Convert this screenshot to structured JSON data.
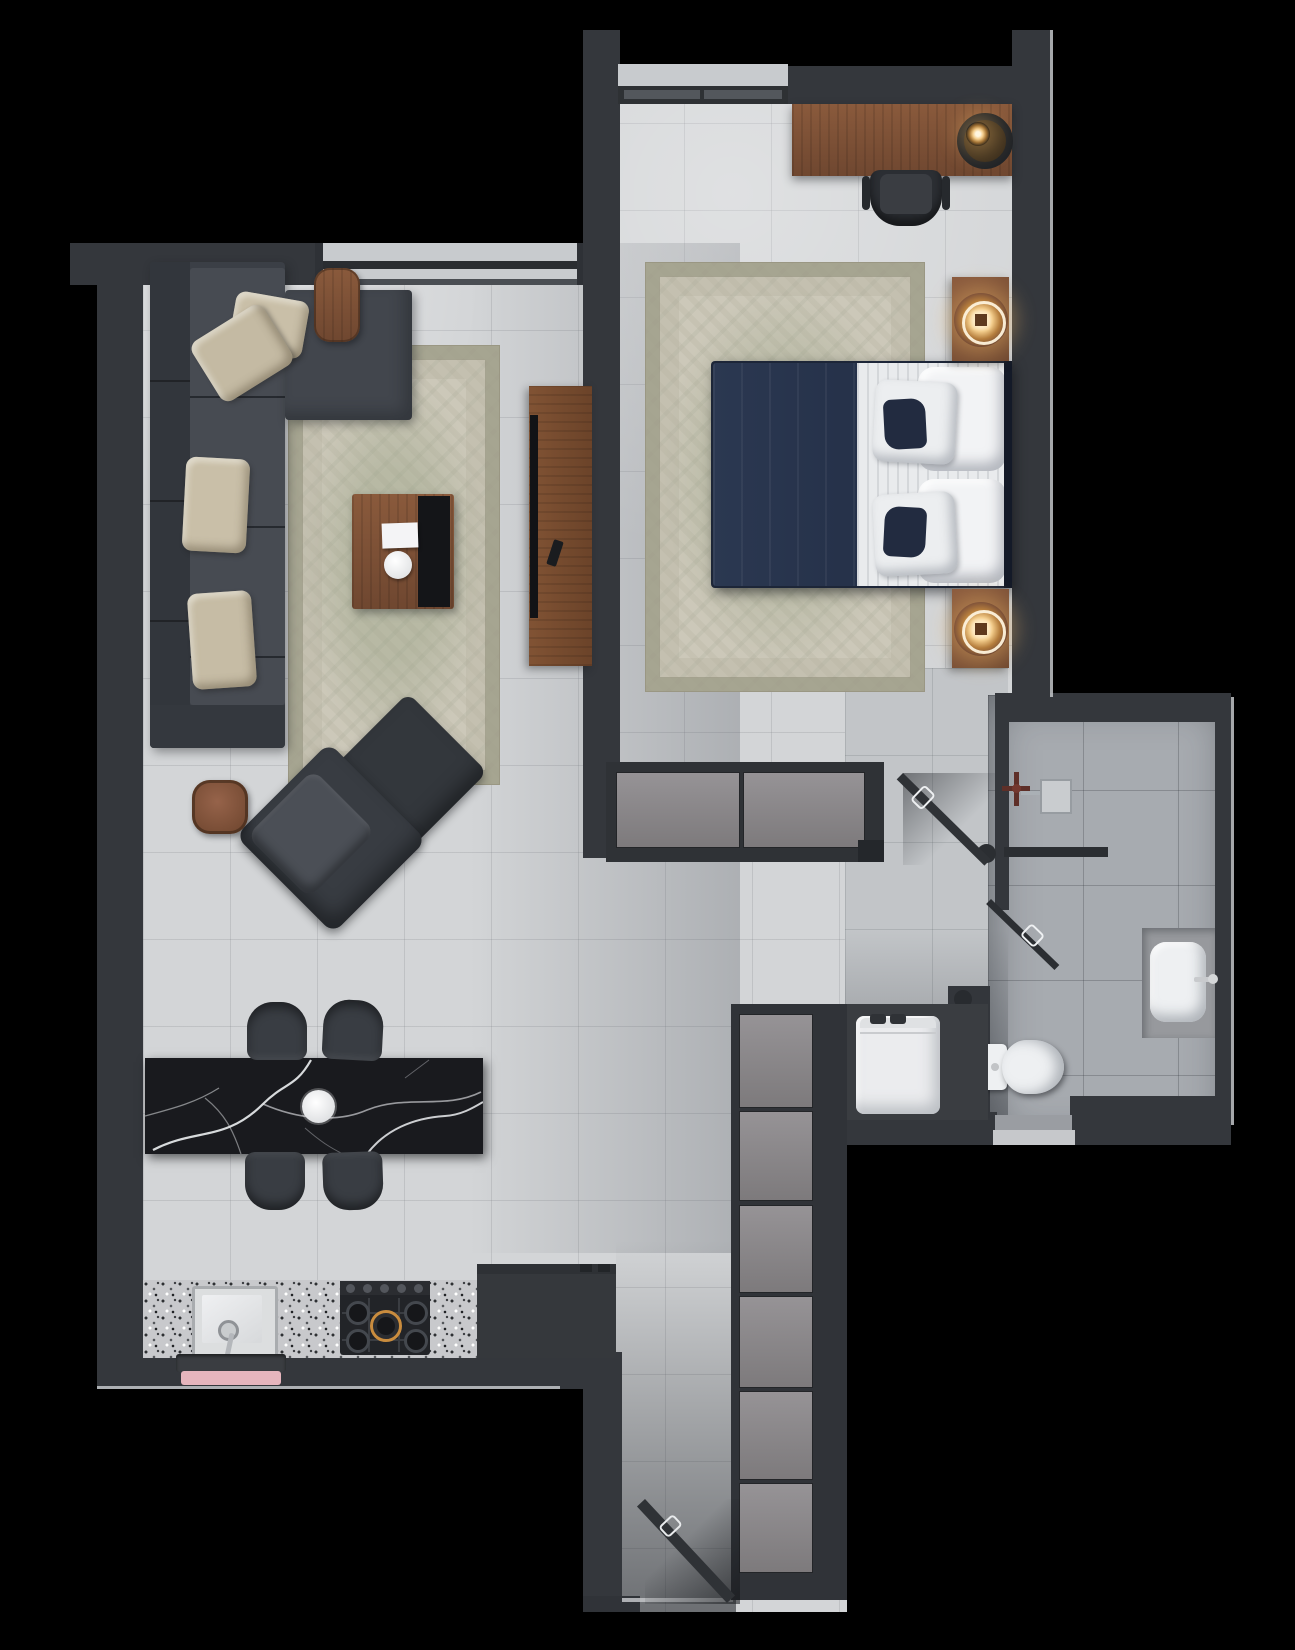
{
  "meta": {
    "kind": "apartment-floor-plan-render",
    "style": "top-down 3d render",
    "text_visible": false
  },
  "palette": {
    "outside": "#000000",
    "wall": "#34373c",
    "wallDark": "#2b2e32",
    "floorLight": "#d3d5d7",
    "floorMid": "#c2c5c8",
    "floorBath": "#a7abb0",
    "edgeHighlight": "#c3c6c9",
    "windowSill": "#c8cbce",
    "wood": "#8a5a3e",
    "woodDark": "#6e4730",
    "rug": "#ccc8b9",
    "sofa": "#3b3f46",
    "sofaSeat": "#474b52",
    "chairDark": "#33373c",
    "islandBlack": "#191a1e",
    "marbleVein": "#eceff1",
    "granite": "#c8c9cc",
    "white": "#eef0f2",
    "bedNavy": "#2b3851",
    "bedNavyDark": "#1d2638",
    "accentNavy": "#222b40",
    "pillowBeige": "#c9bfa8",
    "glowWarm": "#f0c27c",
    "glowCore": "#fff6e0",
    "pink": "#e6b5bd",
    "steel": "#b4b7bb",
    "panelGray": "#8e8b8d",
    "valveRed": "#5e2f28"
  },
  "rooms": [
    {
      "id": "living-room",
      "furniture": [
        "sectional-sofa",
        "throw-pillows",
        "window-side-table",
        "area-rug",
        "coffee-table",
        "black-serving-tray",
        "notebook",
        "tv-console",
        "television",
        "remote",
        "lounge-chair",
        "ottoman-chair",
        "round-side-table"
      ]
    },
    {
      "id": "bedroom",
      "furniture": [
        "desk",
        "desk-lamp",
        "desk-chair",
        "window",
        "area-rug",
        "double-bed",
        "euro-pillows",
        "accent-pillows",
        "nightstand-with-lamp-top",
        "nightstand-with-lamp-bottom",
        "sliding-door-wardrobe"
      ]
    },
    {
      "id": "bathroom",
      "furniture": [
        "walk-in-shower",
        "shower-valve",
        "shower-head",
        "glass-partition",
        "shower-door-ajar",
        "entry-door-ajar",
        "vanity-counter",
        "vessel-sink",
        "faucet",
        "toilet",
        "threshold-mat"
      ]
    },
    {
      "id": "kitchen-dining",
      "furniture": [
        "black-marble-island",
        "dining-chair-1",
        "dining-chair-2",
        "dining-chair-3",
        "dining-chair-4",
        "serving-plate",
        "granite-counter",
        "kitchen-sink",
        "gas-cooktop",
        "refrigerator",
        "dark-mat",
        "pink-mat"
      ]
    },
    {
      "id": "entry-hall",
      "furniture": [
        "tall-storage-cabinet-column",
        "washing-machine",
        "front-door-ajar"
      ]
    }
  ]
}
